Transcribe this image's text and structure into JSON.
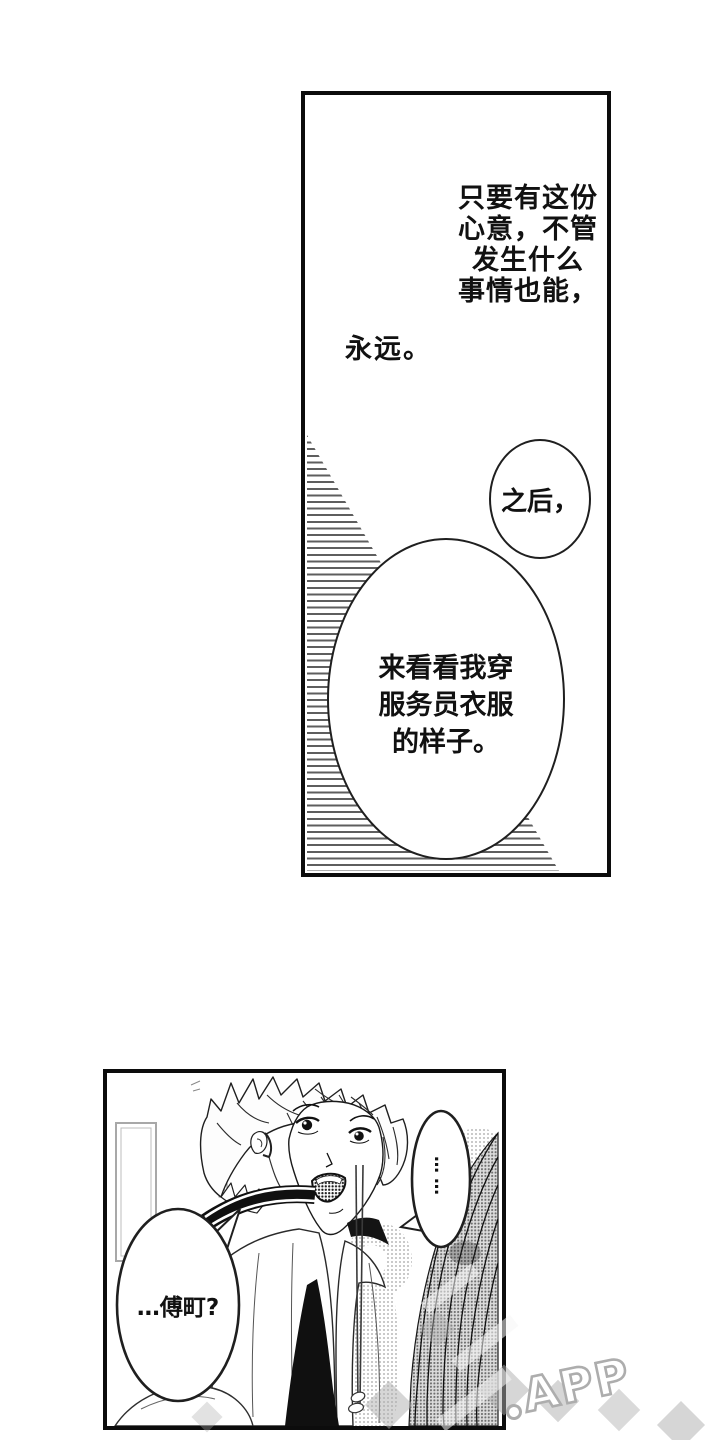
{
  "panel_monologue": {
    "narration_lines": [
      "只要有这份",
      "心意，不管",
      "发生什么",
      "事情也能，"
    ],
    "narration_tail": "永远。",
    "bubble_small_text": "之后，",
    "bubble_large_lines": [
      "来看看我穿",
      "服务员衣服",
      "的样子。"
    ]
  },
  "panel_scene": {
    "bubble_ellipsis_text": "……",
    "bubble_name_text": "…傅町?"
  },
  "watermark": {
    "app_label": "APP"
  },
  "colors": {
    "ink": "#111111",
    "border": "#0c0c0c",
    "hatch": "#5e5e5e",
    "wm": "#adadad"
  }
}
